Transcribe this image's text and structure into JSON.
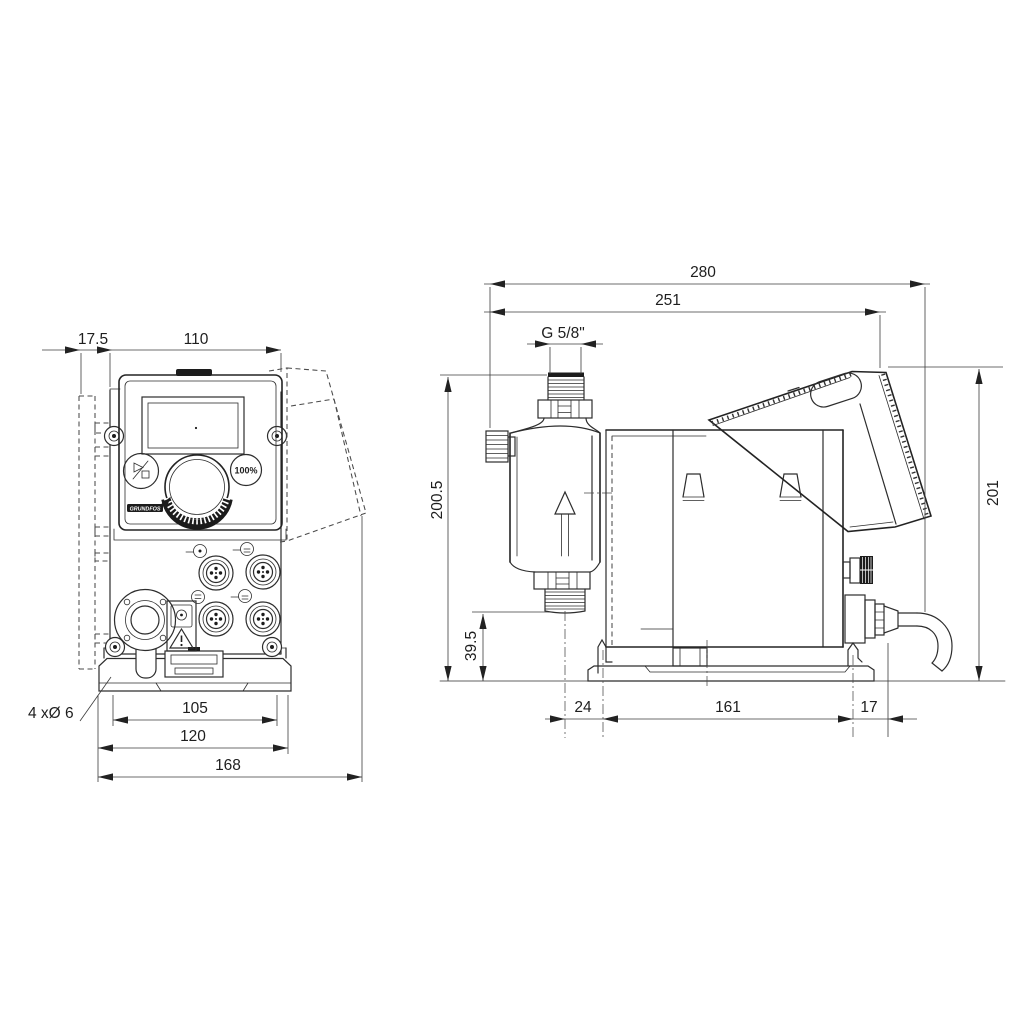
{
  "drawing": {
    "front_view": {
      "dims": {
        "bracket_offset": "17.5",
        "width": "110",
        "hole_spacing": "105",
        "plate_width": "120",
        "total_width": "168",
        "hole_note": "4 xØ 6"
      },
      "panel": {
        "percent_button": "100%",
        "brand": "GRUNDFOS"
      }
    },
    "side_view": {
      "dims": {
        "total_depth": "280",
        "depth_to_cube": "251",
        "thread": "G 5/8\"",
        "height": "200.5",
        "port_height": "39.5",
        "rear_height": "201",
        "front_foot": "24",
        "base_length": "161",
        "rear_foot": "17"
      }
    }
  }
}
